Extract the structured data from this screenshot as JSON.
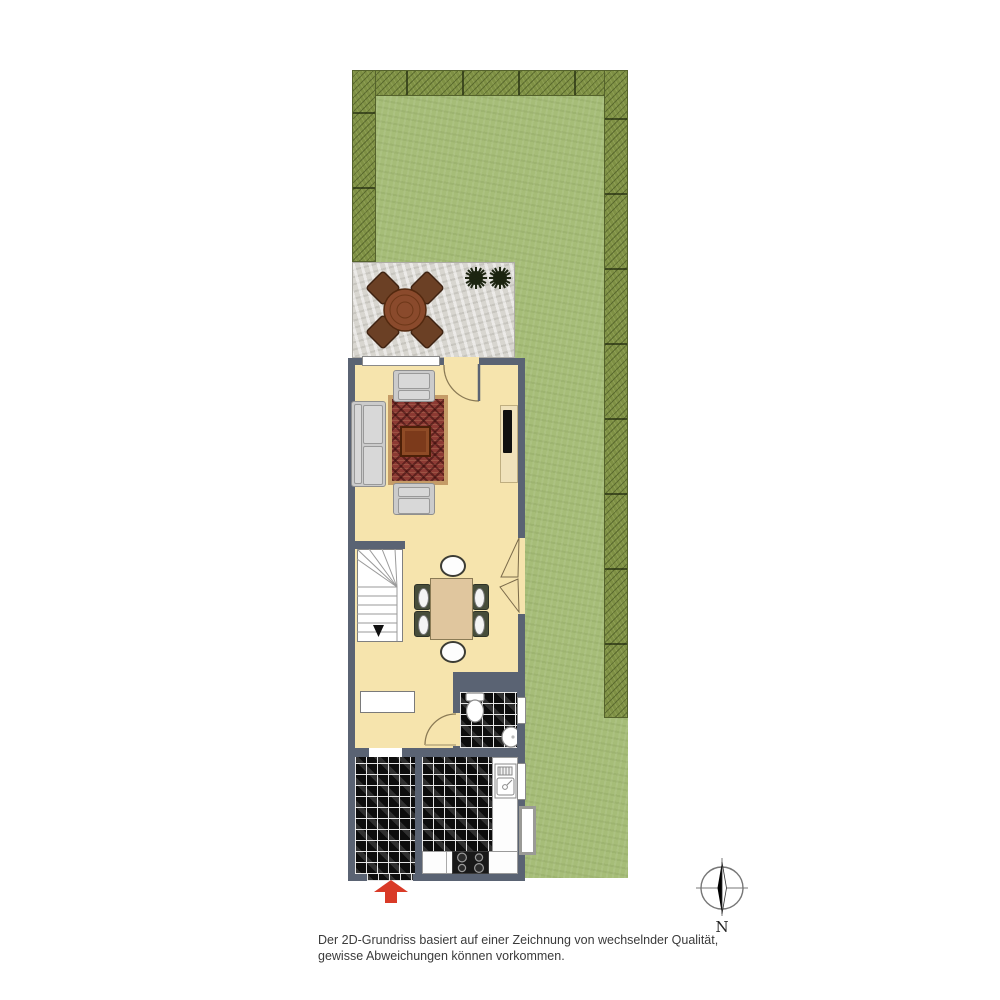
{
  "compass": {
    "label": "N"
  },
  "disclaimer": {
    "line1": "Der 2D-Grundriss basiert auf einer Zeichnung von wechselnder Qualität,",
    "line2": "gewisse Abweichungen können vorkommen."
  },
  "colors": {
    "lawn": "#a6bd78",
    "hedge": "#7e9044",
    "terrace": "#d8d6d0",
    "wall": "#5a6373",
    "floor": "#f6e4ad",
    "tile": "#0d0d0d",
    "rug": "#8c3a33",
    "arrow": "#d93a27"
  }
}
